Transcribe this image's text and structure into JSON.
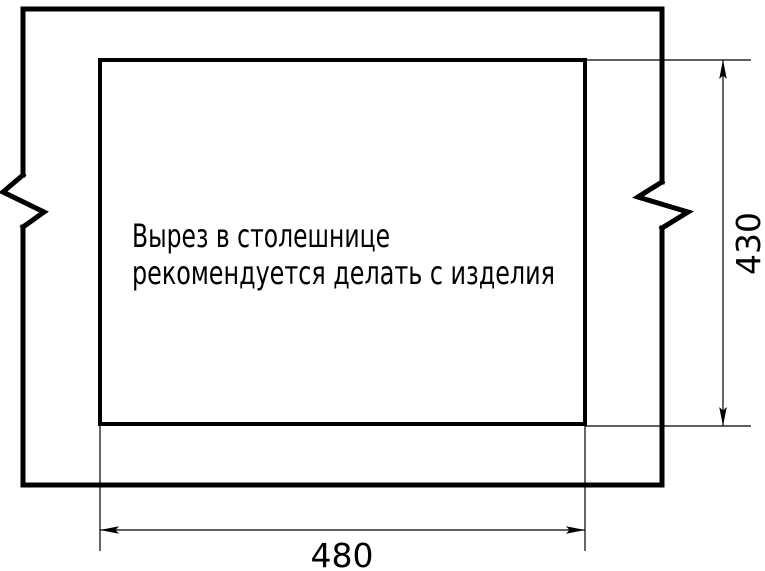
{
  "drawing": {
    "title": "countertop-cutout-drawing",
    "annotation": {
      "line1": "Вырез в столешнице",
      "line2": "рекомендуется делать с изделия"
    },
    "dimensions": {
      "cutout_width": "480",
      "cutout_height": "430"
    },
    "colors": {
      "line": "#000000",
      "background": "#ffffff"
    }
  }
}
